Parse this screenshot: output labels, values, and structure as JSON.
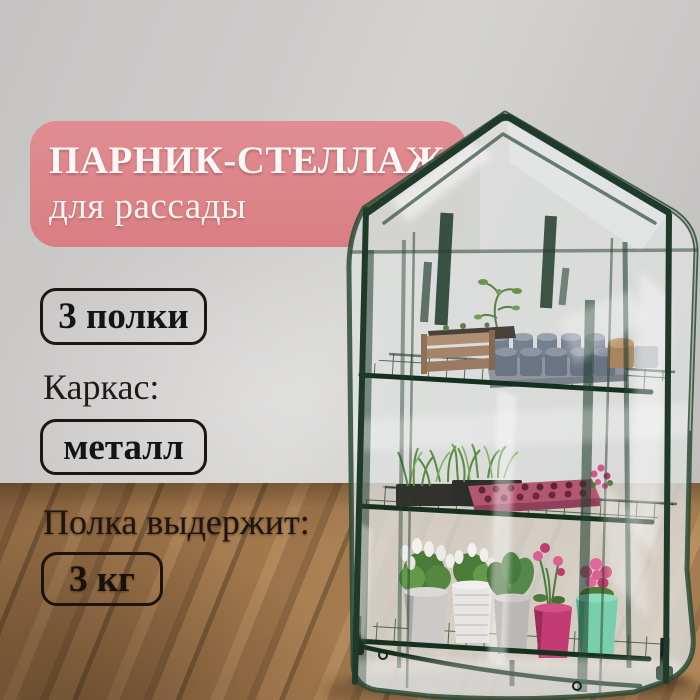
{
  "banner": {
    "title": "ПАРНИК-СТЕЛЛАЖ",
    "subtitle": "для рассады",
    "bg_color": "#dc868a",
    "text_color": "#fdf8f6"
  },
  "specs": {
    "shelves_badge": "3 полки",
    "frame_label": "Каркас:",
    "frame_badge": "металл",
    "load_label": "Полка выдержит:",
    "load_badge": "3 кг"
  },
  "scene": {
    "wall_color": "#cccac9",
    "floor_wood_color": "#96703f",
    "greenhouse_frame_color": "#1f3a2a",
    "greenhouse_film_color": "#dde1df",
    "seedling_tray_color": "#b35672",
    "pot_colors": [
      "#cbcac8",
      "#e6e5e3",
      "#bab8b5",
      "#c23b72",
      "#79ceac"
    ]
  }
}
